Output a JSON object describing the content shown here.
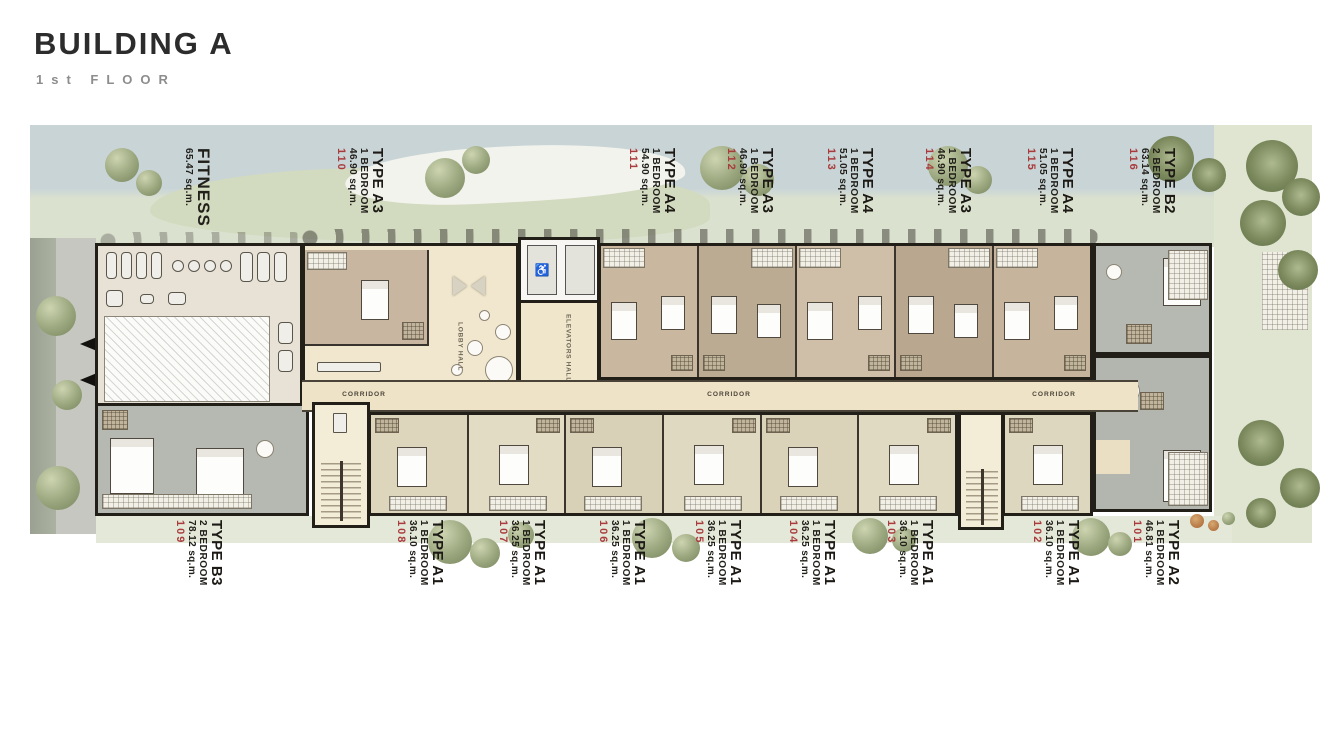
{
  "header": {
    "title": "BUILDING A",
    "subtitle": "1st FLOOR"
  },
  "plan": {
    "corridor_label": "CORRIDOR",
    "lobby_label": "LOBBY HALL",
    "elevators_label": "ELEVATORS HALL",
    "fitness": {
      "label": "FITNESS",
      "area": "65.47 sq.m."
    },
    "units_top": [
      {
        "number": "110",
        "type": "TYPE A3",
        "bedroom": "1 BEDROOM",
        "area": "46.90 sq.m."
      },
      {
        "number": "111",
        "type": "TYPE A4",
        "bedroom": "1 BEDROOM",
        "area": "54.90 sq.m."
      },
      {
        "number": "112",
        "type": "TYPE A3",
        "bedroom": "1 BEDROOM",
        "area": "46.90 sq.m."
      },
      {
        "number": "113",
        "type": "TYPE A4",
        "bedroom": "1 BEDROOM",
        "area": "51.05 sq.m."
      },
      {
        "number": "114",
        "type": "TYPE A3",
        "bedroom": "1 BEDROOM",
        "area": "46.90 sq.m."
      },
      {
        "number": "115",
        "type": "TYPE A4",
        "bedroom": "1 BEDROOM",
        "area": "51.05 sq.m."
      },
      {
        "number": "116",
        "type": "TYPE B2",
        "bedroom": "2 BEDROOM",
        "area": "63.14 sq.m."
      }
    ],
    "units_bottom": [
      {
        "number": "109",
        "type": "TYPE B3",
        "bedroom": "2 BEDROOM",
        "area": "78.12 sq.m."
      },
      {
        "number": "108",
        "type": "TYPE A1",
        "bedroom": "1 BEDROOM",
        "area": "36.10 sq.m."
      },
      {
        "number": "107",
        "type": "TYPE A1",
        "bedroom": "1 BEDROOM",
        "area": "36.25 sq.m."
      },
      {
        "number": "106",
        "type": "TYPE A1",
        "bedroom": "1 BEDROOM",
        "area": "36.25 sq.m."
      },
      {
        "number": "105",
        "type": "TYPE A1",
        "bedroom": "1 BEDROOM",
        "area": "36.25 sq.m."
      },
      {
        "number": "104",
        "type": "TYPE A1",
        "bedroom": "1 BEDROOM",
        "area": "36.25 sq.m."
      },
      {
        "number": "103",
        "type": "TYPE A1",
        "bedroom": "1 BEDROOM",
        "area": "36.10 sq.m."
      },
      {
        "number": "102",
        "type": "TYPE A1",
        "bedroom": "1 BEDROOM",
        "area": "36.10 sq.m."
      },
      {
        "number": "101",
        "type": "TYPE A2",
        "bedroom": "1 BEDROOM",
        "area": "46.81 sq.m."
      }
    ]
  },
  "colors": {
    "unit_number_red": "#a93b3c",
    "text_dark": "#1d1a16",
    "wall": "#221e18",
    "corridor_cream": "#efe3c7",
    "unit_tan": "#c8b6a0",
    "unit_khaki": "#ded7bf",
    "unit_gray": "#b6b9b2",
    "lawn_green": "#dbe1cf",
    "pool_blue": "#c9d4d7",
    "tree_olive": "#8d9a71"
  }
}
